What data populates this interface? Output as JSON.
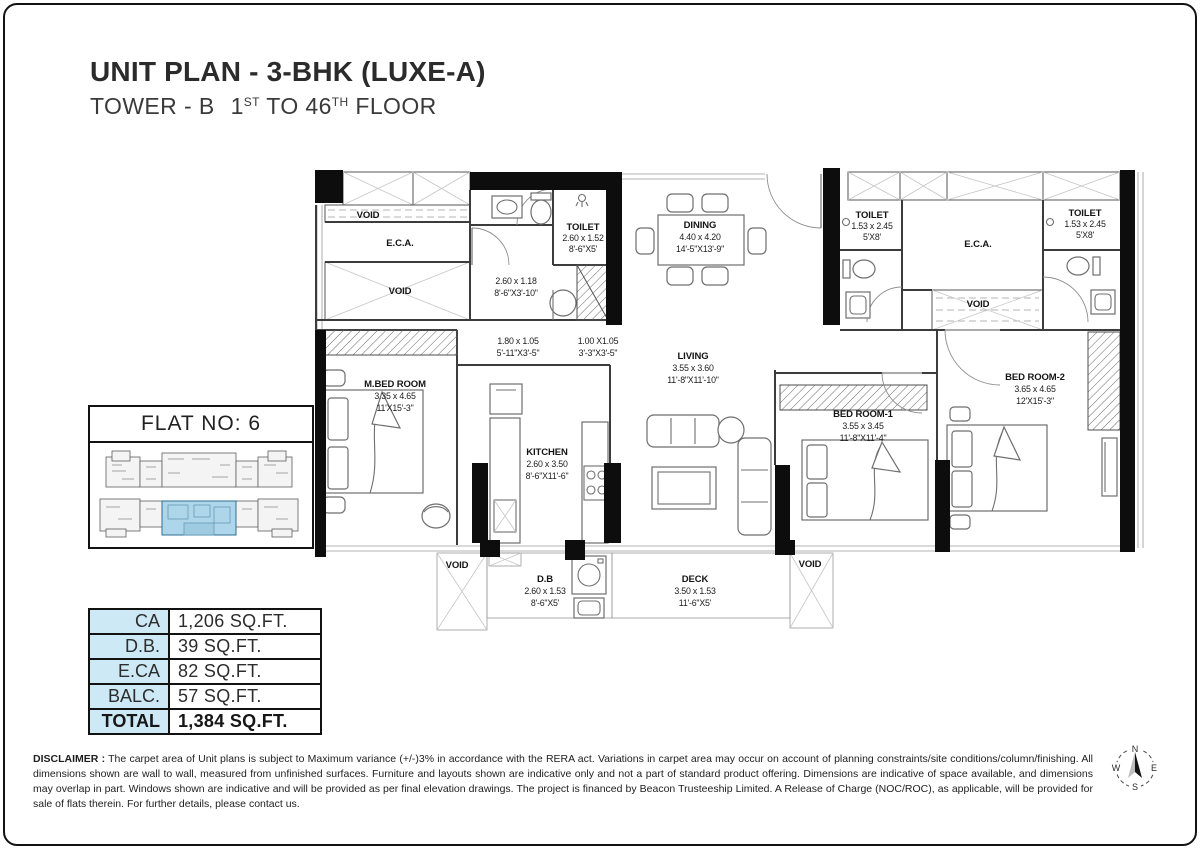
{
  "header": {
    "title": "UNIT PLAN - 3-BHK (LUXE-A)",
    "subtitle_pre": "TOWER - B",
    "subtitle_n1": "1",
    "subtitle_sup1": "ST",
    "subtitle_mid": " TO 46",
    "subtitle_sup2": "TH",
    "subtitle_post": " FLOOR"
  },
  "flat_box": {
    "title": "FLAT NO: 6"
  },
  "area_table": {
    "rows": [
      {
        "label": "CA",
        "value": "1,206  SQ.FT."
      },
      {
        "label": "D.B.",
        "value": "39 SQ.FT."
      },
      {
        "label": "E.CA",
        "value": "82 SQ.FT."
      },
      {
        "label": "BALC.",
        "value": "57 SQ.FT."
      },
      {
        "label": "TOTAL",
        "value": "1,384 SQ.FT."
      }
    ]
  },
  "plan": {
    "rooms": [
      {
        "name": "VOID"
      },
      {
        "name": "E.C.A."
      },
      {
        "name": "VOID"
      },
      {
        "name": "TOILET",
        "m": "2.60 x 1.52",
        "ft": "8'-6\"X5'"
      },
      {
        "m": "2.60 x 1.18",
        "ft": "8'-6\"X3'-10\""
      },
      {
        "name": "DINING",
        "m": "4.40 x 4.20",
        "ft": "14'-5\"X13'-9\""
      },
      {
        "name": "TOILET",
        "m": "1.53 x 2.45",
        "ft": "5'X8'"
      },
      {
        "name": "E.C.A."
      },
      {
        "name": "TOILET",
        "m": "1.53 x 2.45",
        "ft": "5'X8'"
      },
      {
        "name": "VOID"
      },
      {
        "m": "1.80 x 1.05",
        "ft": "5'-11\"X3'-5\""
      },
      {
        "m": "1.00 X1.05",
        "ft": "3'-3\"X3'-5\""
      },
      {
        "name": "LIVING",
        "m": "3.55 x 3.60",
        "ft": "11'-8\"X11'-10\""
      },
      {
        "name": "M.BED ROOM",
        "m": "3.35 x 4.65",
        "ft": "11'X15'-3\""
      },
      {
        "name": "KITCHEN",
        "m": "2.60 x 3.50",
        "ft": "8'-6\"X11'-6\""
      },
      {
        "name": "BED ROOM-1",
        "m": "3.55 x 3.45",
        "ft": "11'-8\"X11'-4\""
      },
      {
        "name": "BED ROOM-2",
        "m": "3.65 x 4.65",
        "ft": "12'X15'-3\""
      },
      {
        "name": "VOID"
      },
      {
        "name": "D.B",
        "m": "2.60 x 1.53",
        "ft": "8'-6\"X5'"
      },
      {
        "name": "DECK",
        "m": "3.50 x 1.53",
        "ft": "11'-6\"X5'"
      },
      {
        "name": "VOID"
      }
    ]
  },
  "disclaimer": {
    "label": "DISCLAIMER :",
    "text": "The carpet area of Unit plans is subject to Maximum variance (+/-)3% in accordance with the RERA act. Variations in carpet area may occur on account of planning constraints/site conditions/column/finishing. All dimensions shown are wall to wall, measured from unfinished surfaces. Furniture and layouts shown are indicative only and not a part of standard product offering. Dimensions are indicative of space available, and dimensions may overlap in part. Windows shown are indicative and will be provided as per final elevation drawings. The project is financed by Beacon Trusteeship Limited. A Release of Charge (NOC/ROC), as applicable, will be provided for sale of flats therein. For further details, please contact us."
  },
  "compass": {
    "n": "N",
    "e": "E",
    "s": "S",
    "w": "W"
  },
  "colors": {
    "table_label_bg": "#cde9f6",
    "keyplan_highlight": "#aed6ea",
    "line": "#3c3c3c"
  }
}
